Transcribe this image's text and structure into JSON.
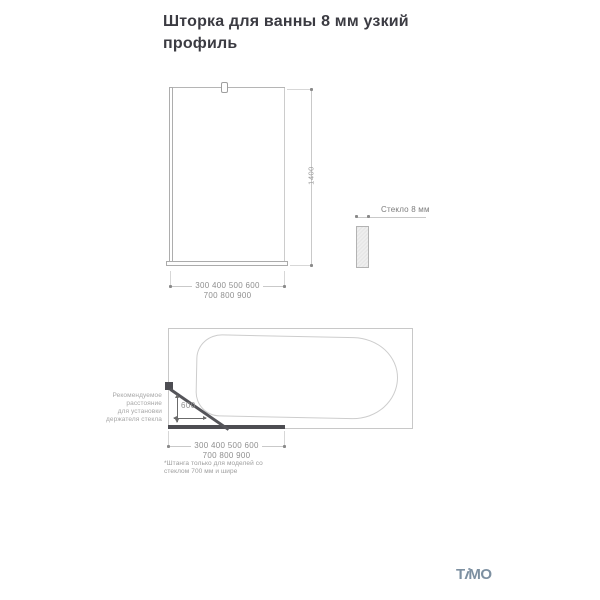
{
  "title": "Шторка для ванны 8 мм узкий профиль",
  "front_view": {
    "height_dim": "1400",
    "width_dim_row1": "300 400 500 600",
    "width_dim_row2": "700 800 900"
  },
  "glass_section": {
    "label": "Стекло 8 мм"
  },
  "top_view": {
    "note_lines": [
      "Рекомендуемое",
      "расстояние",
      "для установки",
      "держателя стекла"
    ],
    "holder_distance": "600",
    "width_dim_row1": "300 400 500 600",
    "width_dim_row2": "700 800 900",
    "footnote_lines": [
      "*Штанга только для моделей со",
      "стеклом 700 мм и шире"
    ]
  },
  "logo": {
    "brand": "TIMO",
    "part_t": "T",
    "part_i": "i",
    "part_mo": "MO",
    "color": "#7d90a1"
  },
  "colors": {
    "title_text": "#3b3b42",
    "line_light": "#c9c9c9",
    "line_dark": "#4d4d52",
    "dim_text": "#8f8f8f"
  }
}
